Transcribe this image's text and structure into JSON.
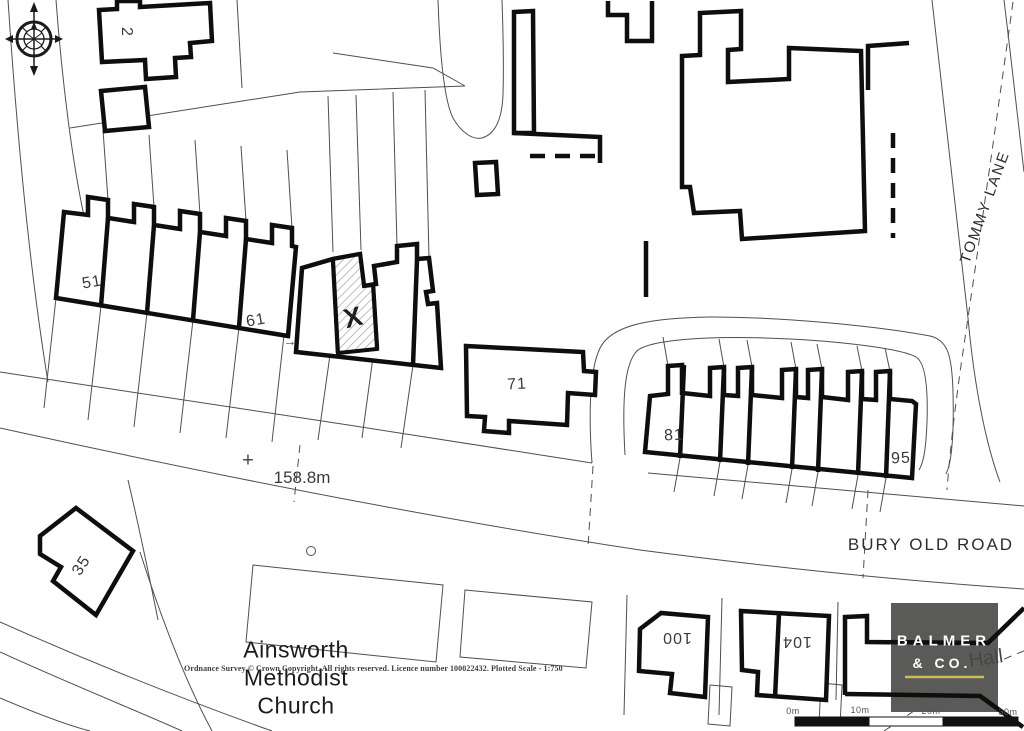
{
  "map": {
    "road_labels": {
      "tommy_lane": "TOMMY LANE",
      "bury_old_road": "BURY OLD ROAD"
    },
    "spot_height": {
      "symbol": "+",
      "value": "158.8m"
    },
    "subject_plot": {
      "mark": "X"
    },
    "pointer": {
      "arrow": "→"
    },
    "house_numbers": {
      "n2": "2",
      "n35": "35",
      "n51": "51",
      "n61": "61",
      "n71": "71",
      "n81": "81",
      "n95": "95",
      "n100": "100",
      "n104": "104"
    },
    "places": {
      "church": [
        "Ainsworth",
        "Methodist",
        "Church"
      ],
      "hall": "Hall"
    }
  },
  "attribution": "Ordnance Survey © Crown Copyright. All rights reserved. Licence number 100022432. Plotted Scale - 1:750",
  "scale_bar": {
    "labels": [
      "0m",
      "10m",
      "20m",
      "30m"
    ]
  },
  "logo": {
    "name": "BALMER",
    "suffix": "& CO.",
    "bg_color": "#5a5a58",
    "underline_color": "#c9bd55"
  }
}
